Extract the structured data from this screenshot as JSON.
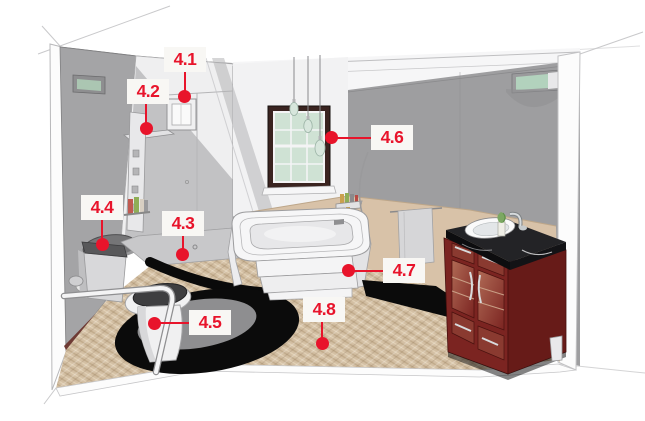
{
  "figure": {
    "type": "annotated-3d-rendering",
    "subject": "accessible bathroom cutaway"
  },
  "callouts": [
    {
      "label": "4.1"
    },
    {
      "label": "4.2"
    },
    {
      "label": "4.3"
    },
    {
      "label": "4.4"
    },
    {
      "label": "4.5"
    },
    {
      "label": "4.6"
    },
    {
      "label": "4.7"
    },
    {
      "label": "4.8"
    }
  ],
  "colors": {
    "callout_text": "#e8142b",
    "callout_leader": "#e8142b",
    "callout_box_bg": "#f8f7f4",
    "wall_gray": "#a4a4a6",
    "wainscot_tan": "#d8c2a8",
    "carpet_tan": "#d3bfa3",
    "window_frame": "#3a2420",
    "window_glass": "#cfe2d4",
    "vanity_wood": "#7b2421",
    "countertop": "#18181b",
    "rug_black": "#0b0b0b"
  }
}
